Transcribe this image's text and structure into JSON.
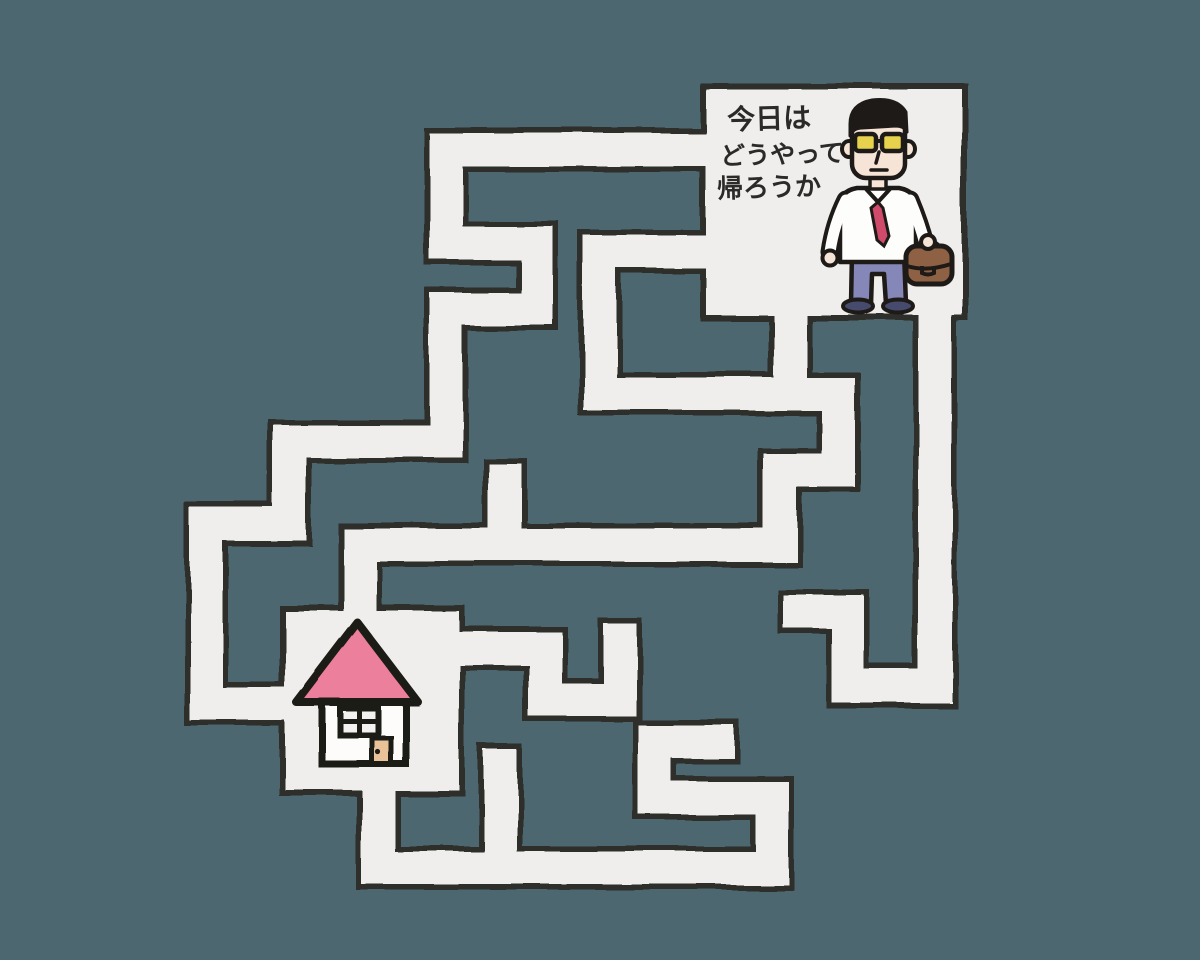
{
  "scene": {
    "description": "Hand-drawn maze puzzle: businessman must find his way home",
    "background_color": "#4c6770",
    "corridor_color": "#efeeec",
    "outline_color": "#2e2d2b"
  },
  "speech": {
    "lines": [
      "今日は",
      "どうやって",
      "帰ろうか"
    ],
    "color": "#2b2a28"
  },
  "start_figure": {
    "name": "businessman",
    "shirt_color": "#fdfdfc",
    "tie_color": "#cf4a6b",
    "pants_color": "#8487b8",
    "shoes_color": "#464b6e",
    "briefcase_color": "#8f6144",
    "skin_color": "#f6e4d6",
    "glasses_lens_color": "#e7d24d",
    "hair_color": "#1d1a17"
  },
  "goal_house": {
    "name": "house",
    "roof_color": "#ec7f9b",
    "wall_color": "#fdfcfb",
    "door_color": "#e9c29a",
    "window_color": "#f4f2f0"
  }
}
